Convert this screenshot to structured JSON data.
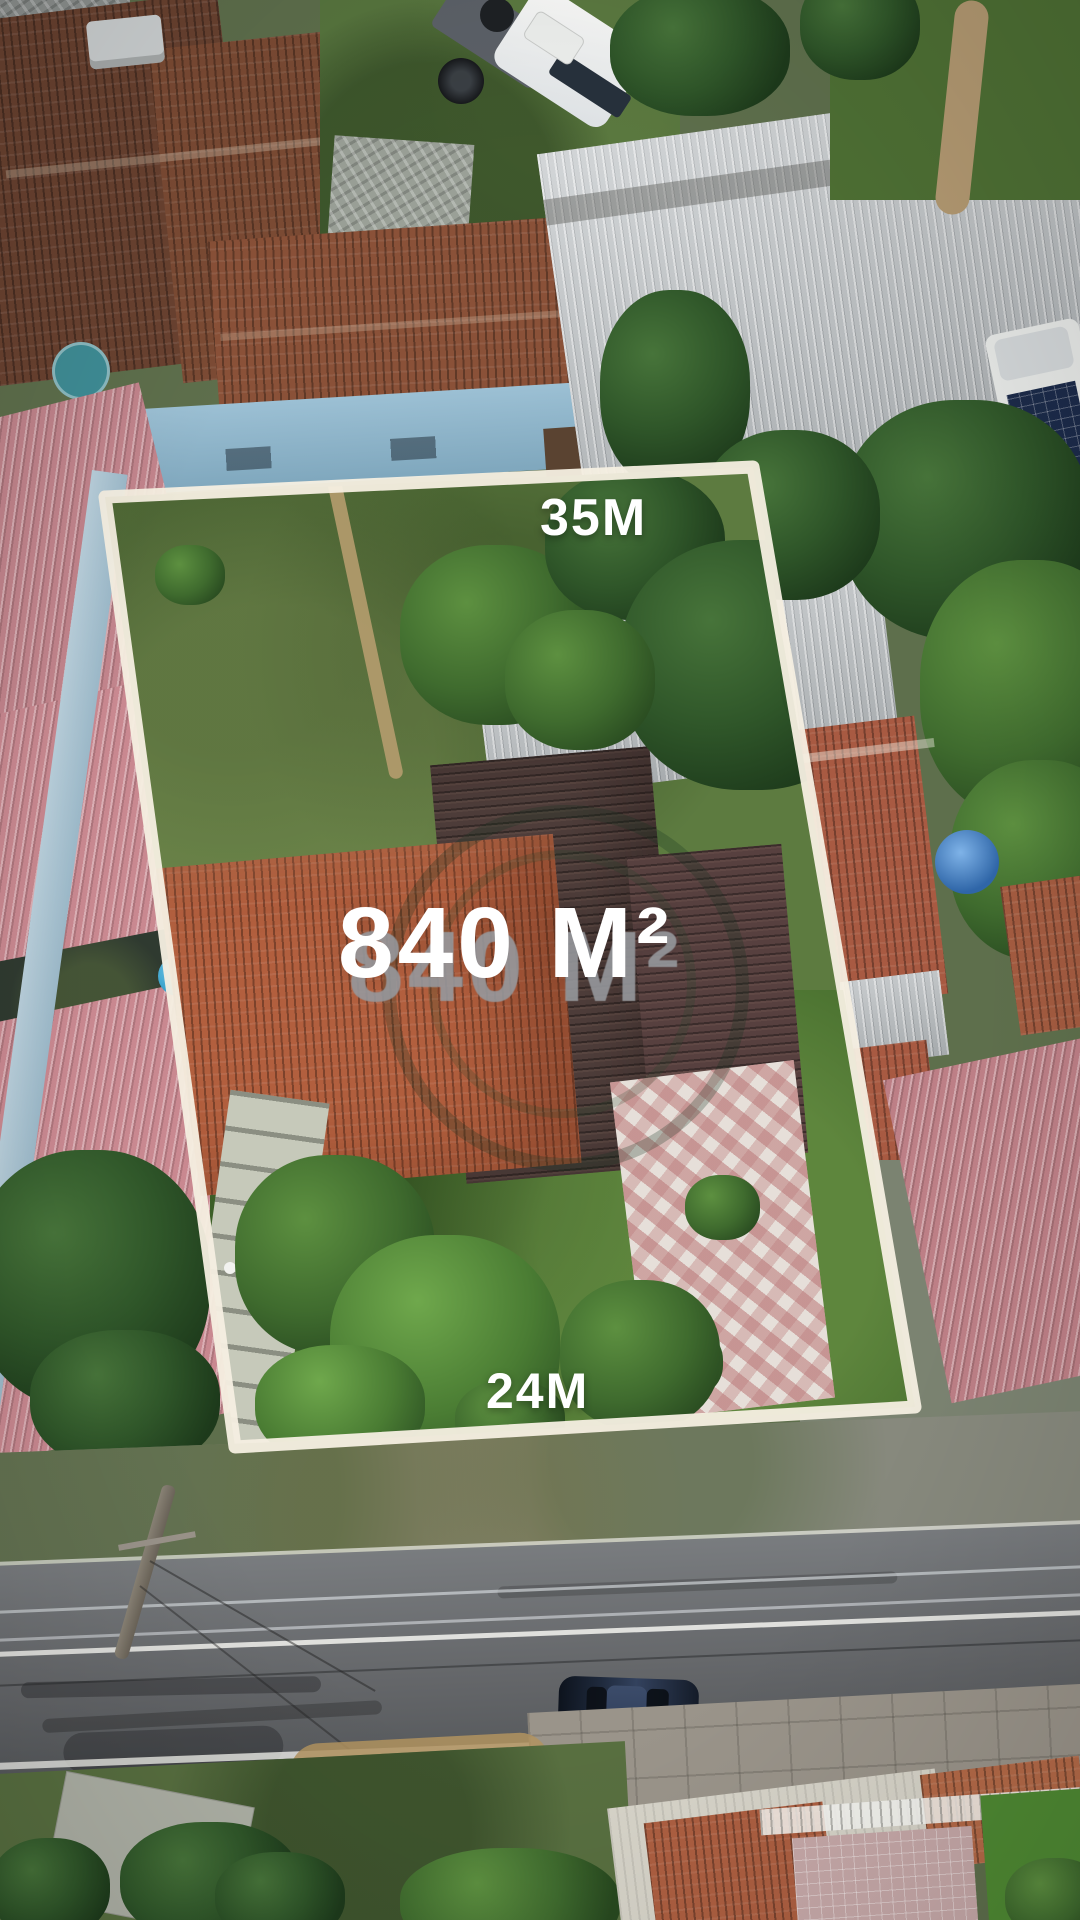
{
  "annotations": {
    "top_side_length": "35M",
    "area": "840 M²",
    "bottom_side_length": "24M"
  },
  "overlay": {
    "watermark": "circular-logo-watermark",
    "boundary_shape": "property-lot-outline"
  },
  "palette": {
    "boundary_line": "#f5efe2",
    "label_text": "#ffffff",
    "label_shadow": "#969aa0",
    "lawn_green": "#5d7b40",
    "roof_orange": "#b25f3e",
    "roof_dark": "#4e3d3a",
    "roof_pink": "#c2858c",
    "metal_roof": "#b8bdc0",
    "road_asphalt": "#6a6d70",
    "pool_blue": "#3fb2da",
    "car_navy": "#1f2a3d",
    "truck_white": "#eef0ee"
  }
}
